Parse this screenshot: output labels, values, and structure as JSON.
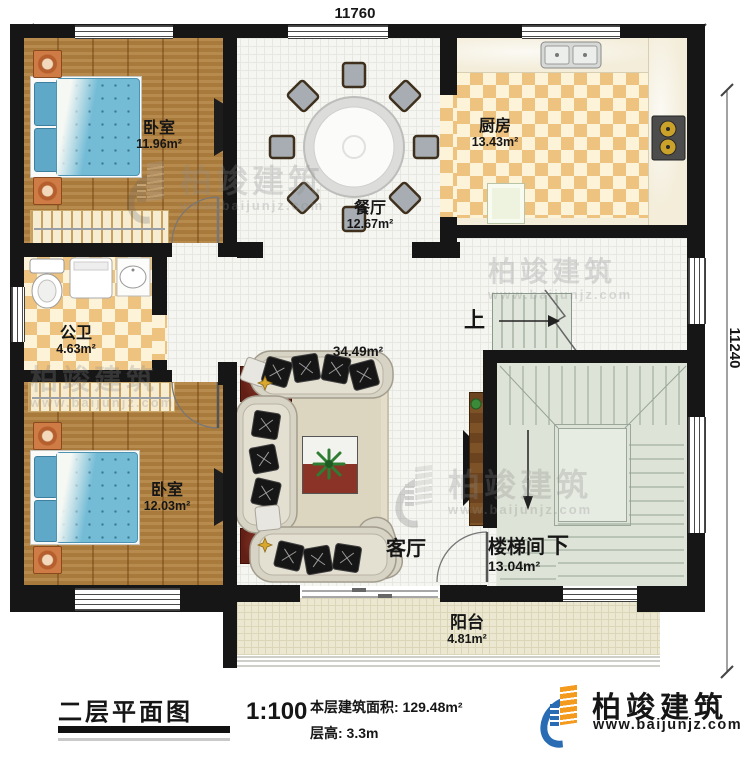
{
  "plan": {
    "dimensions": {
      "top": "11760",
      "right": "11240"
    },
    "rooms": {
      "bedroom_top": {
        "name": "卧室",
        "area": "11.96m²"
      },
      "dining": {
        "name": "餐厅",
        "area": "12.67m²"
      },
      "kitchen": {
        "name": "厨房",
        "area": "13.43m²"
      },
      "bathroom": {
        "name": "公卫",
        "area": "4.63m²"
      },
      "living": {
        "name": "客厅",
        "area": "34.49m²"
      },
      "bedroom_bottom": {
        "name": "卧室",
        "area": "12.03m²"
      },
      "stairwell": {
        "name": "楼梯间",
        "area": "13.04m²",
        "up": "上",
        "down": "下"
      },
      "balcony": {
        "name": "阳台",
        "area": "4.81m²"
      }
    },
    "watermark": {
      "brand": "柏竣建筑",
      "url": "www.baijunjz.com"
    }
  },
  "titleblock": {
    "title": "二层平面图",
    "scale": "1:100",
    "area_label": "本层建筑面积: 129.48m²",
    "floor_height_label": "层高: 3.3m"
  },
  "logo": {
    "brand": "柏竣建筑",
    "url": "www.baijunjz.com"
  },
  "colors": {
    "wall": "#161616",
    "wood_floor": "#b1803e",
    "tile": "#eec37f",
    "tile_light": "#fdf3d8",
    "stair_floor": "#dde3d6",
    "balcony_floor": "#ebe7d0",
    "bed_blue": "#74bcd6",
    "brand_blue": "#2a6cb4",
    "brand_orange": "#f49a1c"
  }
}
